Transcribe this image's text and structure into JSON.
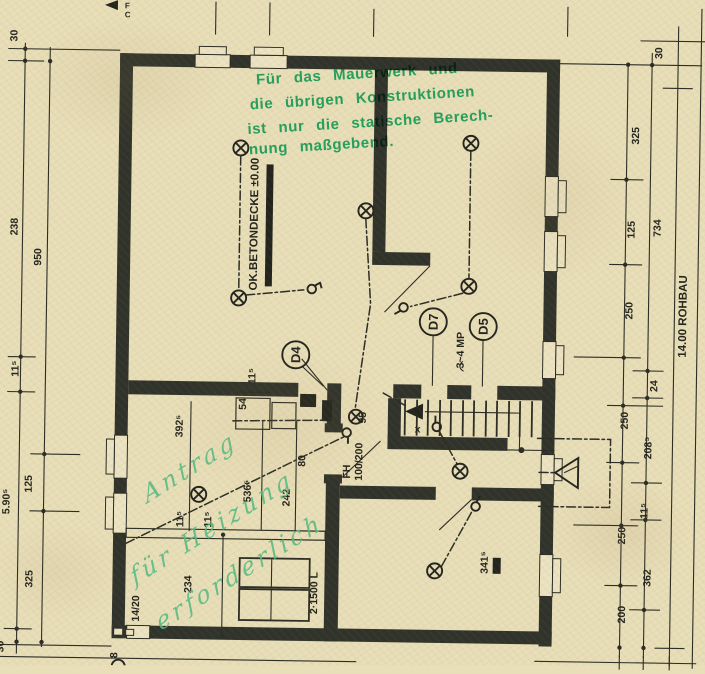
{
  "colors": {
    "paper": "#e8deb8",
    "ink": "#2b2c25",
    "wall": "#30332b",
    "stamp_green": "#149a55",
    "pencil_green": "#55bb83"
  },
  "stamp": {
    "line1": "Für das Mauerwerk und",
    "line2": "die übrigen Konstruktionen",
    "line3": "ist nur die statische Berech-",
    "line4": "nung maßgebend."
  },
  "handwriting": {
    "line1": "Antrag",
    "line2": "für Heizung",
    "line3": "erforderlich"
  },
  "door_labels": {
    "d4": "D4",
    "d7": "D7",
    "d5": "D5"
  },
  "labels": {
    "l30t": "30",
    "l238": "238",
    "l950": "950",
    "l115": "11⁵",
    "l590": "5.90⁵",
    "l125": "125",
    "l325": "325",
    "l30b": "30",
    "r30": "30",
    "r325": "325",
    "r125": "125",
    "r734": "734",
    "r250a": "250",
    "rohbau": "14.00 ROHBAU",
    "r24": "24",
    "r250b": "250",
    "r2085": "208⁵",
    "r115": "11⁵",
    "r250c": "250",
    "r362": "362",
    "r200": "200",
    "betondecke": "OK.BETONDECKE ±0.00",
    "d95": "95",
    "d80": "80",
    "d54": "54",
    "d115a": "11⁵",
    "d3925": "392⁵",
    "d5365": "536⁵",
    "d242": "242",
    "d115b": "11⁵",
    "d115c": "11⁵",
    "d234": "234",
    "beam": "14/20",
    "tanks": "2·1500 L",
    "d3415": "341⁵",
    "fh": "FH",
    "fhsize": "100/200",
    "mp": "3~4 MP",
    "sx": "x",
    "m8": "8",
    "cf": "F",
    "cc": "C"
  }
}
